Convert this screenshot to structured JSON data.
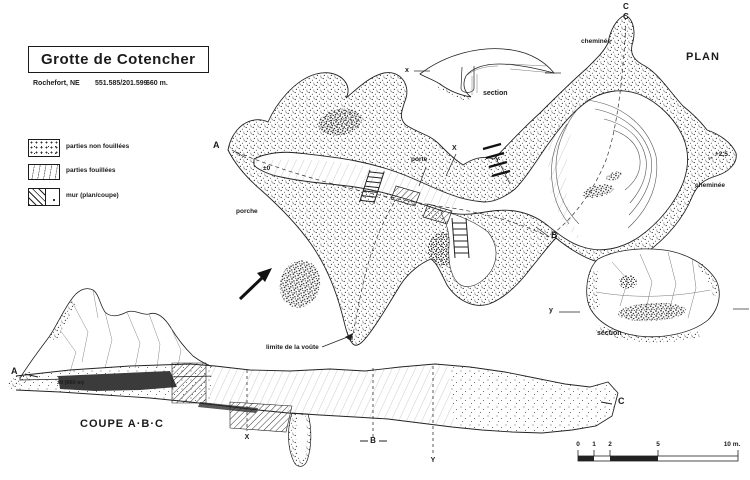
{
  "colors": {
    "ink": "#1b1b1b",
    "paper": "#ffffff",
    "stipple": "#333333",
    "dark_layer": "#3b3b3b"
  },
  "header": {
    "title": "Grotte de Cotencher",
    "location": "Rochefort, NE",
    "coordinates": "551.585/201.599",
    "altitude": "660 m."
  },
  "legend": {
    "items": [
      {
        "swatch": "stipple-texture",
        "label": "parties non fouillées"
      },
      {
        "swatch": "line-texture",
        "label": "parties fouillées"
      },
      {
        "swatch": "hatch-texture",
        "label": "mur (plan/coupe)"
      }
    ]
  },
  "plan": {
    "heading": "PLAN",
    "labels": {
      "chimney_top": "cheminée",
      "chimney_right": "cheminée",
      "porch": "porche",
      "door": "porte",
      "vault_limit": "limite de la voûte",
      "datum_zero": "±0",
      "elevation_plus": "+2,5"
    },
    "markers": {
      "a": "A",
      "b": "B",
      "c_top": "C",
      "c_bottom": "C",
      "x": "X",
      "y": "Y"
    }
  },
  "section_top": {
    "marker": "x",
    "label": "section"
  },
  "section_bottom": {
    "marker": "y",
    "label": "section"
  },
  "coupe": {
    "heading": "COUPE A·B·C",
    "datum": "±0 (660 m)",
    "markers": {
      "a": "A",
      "b": "B",
      "c": "C",
      "x": "X",
      "y": "Y"
    }
  },
  "scalebar": {
    "ticks": [
      "0",
      "1",
      "2",
      "5"
    ],
    "end_label": "10 m."
  }
}
